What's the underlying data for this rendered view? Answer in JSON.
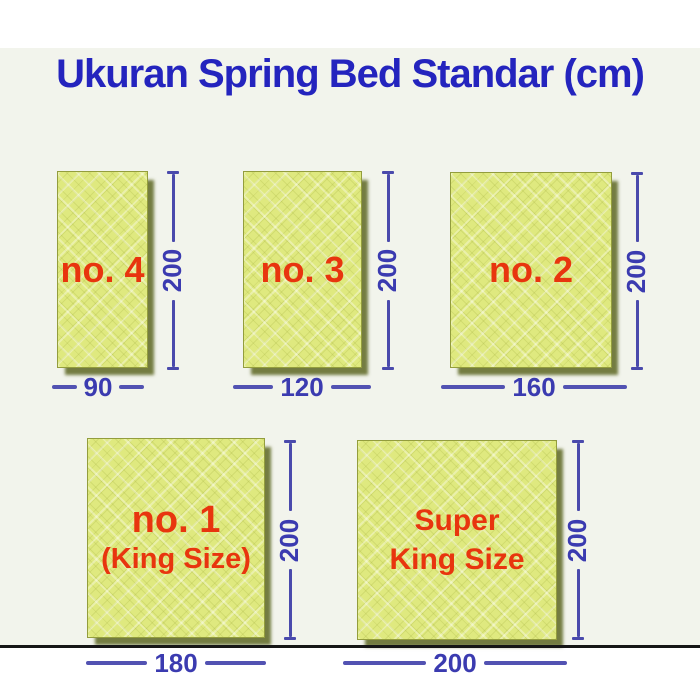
{
  "title": "Ukuran Spring Bed Standar (cm)",
  "unit": "cm",
  "mattresses": [
    {
      "id": "no4",
      "label": "no. 4",
      "sublabel": "",
      "width_label": "90",
      "height_label": "200",
      "width_cm": 90,
      "height_cm": 200
    },
    {
      "id": "no3",
      "label": "no. 3",
      "sublabel": "",
      "width_label": "120",
      "height_label": "200",
      "width_cm": 120,
      "height_cm": 200
    },
    {
      "id": "no2",
      "label": "no. 2",
      "sublabel": "",
      "width_label": "160",
      "height_label": "200",
      "width_cm": 160,
      "height_cm": 200
    },
    {
      "id": "no1",
      "label": "no. 1",
      "sublabel": "(King Size)",
      "width_label": "180",
      "height_label": "200",
      "width_cm": 180,
      "height_cm": 200
    },
    {
      "id": "superking",
      "label": "Super",
      "sublabel": "King Size",
      "width_label": "200",
      "height_label": "200",
      "width_cm": 200,
      "height_cm": 200
    }
  ],
  "colors": {
    "title_blue": "#2424be",
    "dimension_blue": "#4a4aac",
    "dimension_number_blue": "#3b3bb0",
    "label_red": "#e8350e",
    "mattress_fill": "#dfe97f",
    "mattress_border": "#939d3d",
    "mattress_shadow": "#545e16",
    "panel_background": "#f2f4ec",
    "page_background": "#ffffff",
    "bottom_line": "#161616"
  }
}
